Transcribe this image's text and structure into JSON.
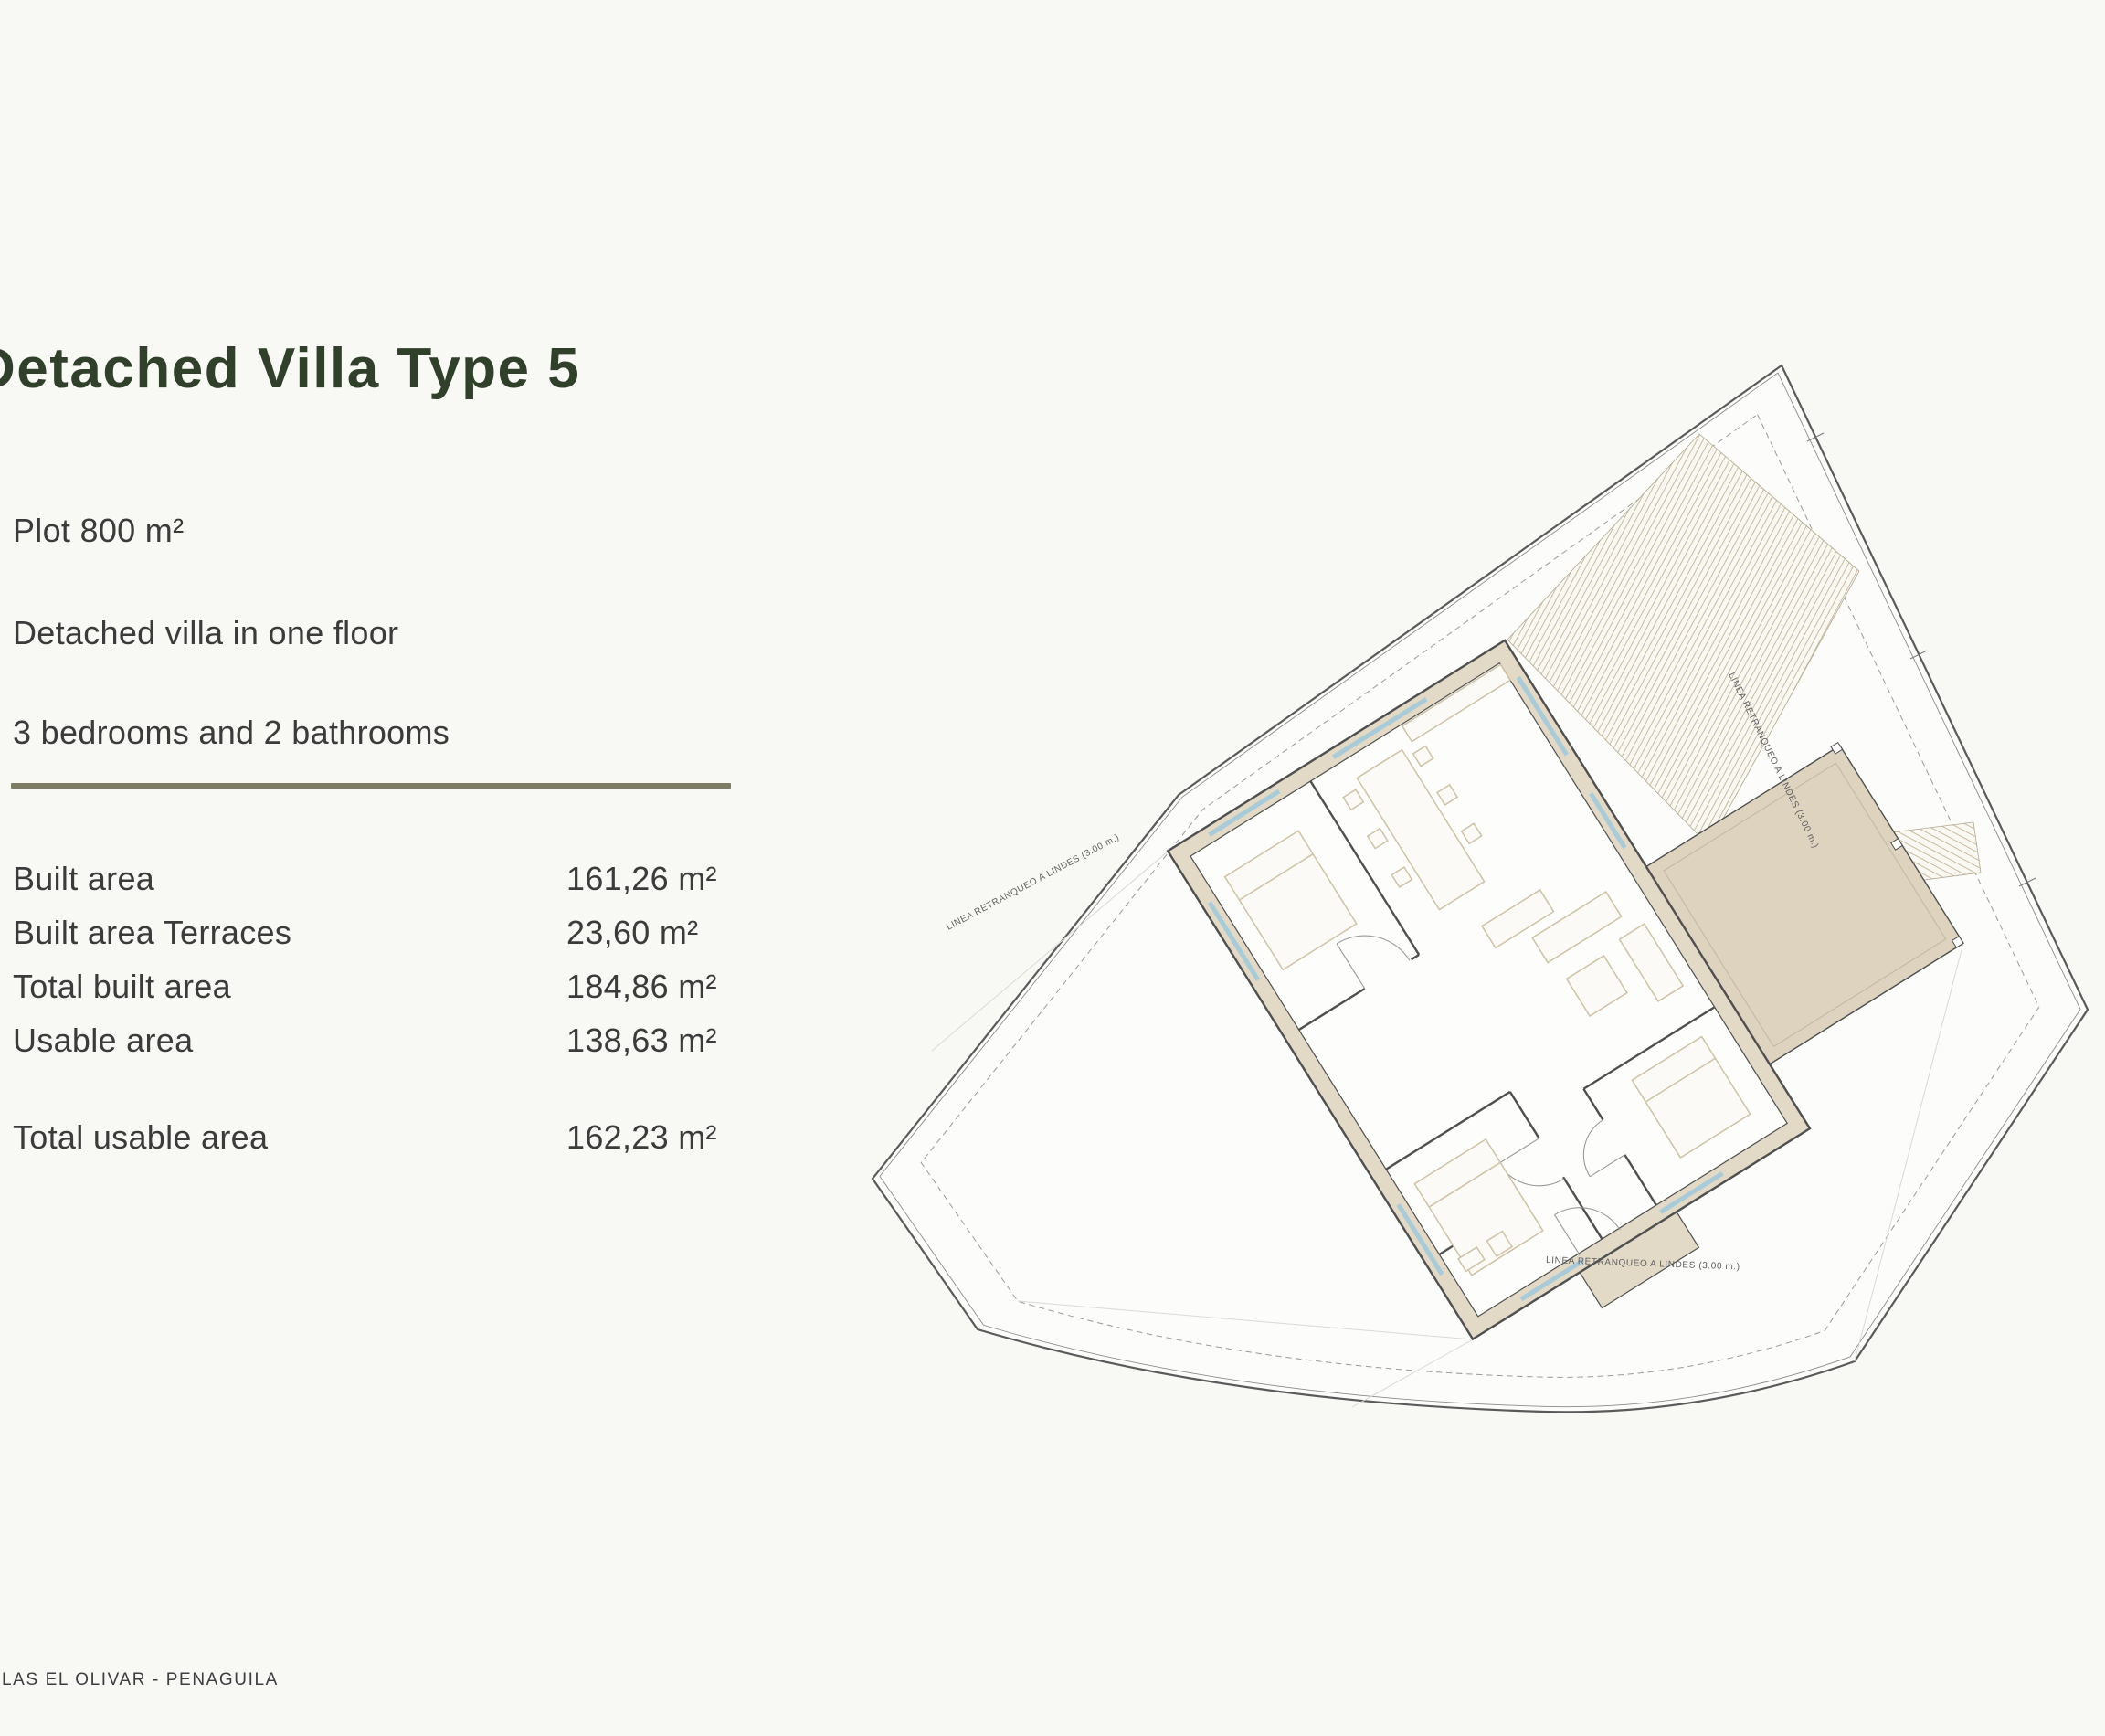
{
  "page": {
    "title": "Detached Villa Type 5",
    "footer": "LAS EL OLIVAR - PENAGUILA",
    "title_color": "#30402a",
    "accent_line_color": "#7d7d65",
    "background": "#f8f8f5"
  },
  "specs": {
    "plot": "Plot 800 m²",
    "floors": "Detached villa in one floor",
    "rooms": "3 bedrooms and 2 bathrooms"
  },
  "areas": {
    "rows": [
      {
        "label": "Built area",
        "value": "161,26 m²"
      },
      {
        "label": "Built area Terraces",
        "value": "23,60 m²"
      },
      {
        "label": "Total built area",
        "value": "184,86 m²"
      },
      {
        "label": "Usable area",
        "value": "138,63 m²"
      }
    ],
    "total": {
      "label": "Total usable area",
      "value": "162,23 m²"
    }
  },
  "plan": {
    "setback_label": "LINEA RETRANQUEO A LINDES (3.00 m.)",
    "boundary_color": "#5a5a5a",
    "wall_color": "#4f4f4f",
    "wall_fill": "#e2d9c7",
    "terrace_fill": "#ddd3bf",
    "hatch_color": "#c8bba2",
    "window_color": "#a9cbd8",
    "furniture_color": "#cfc2a6"
  }
}
